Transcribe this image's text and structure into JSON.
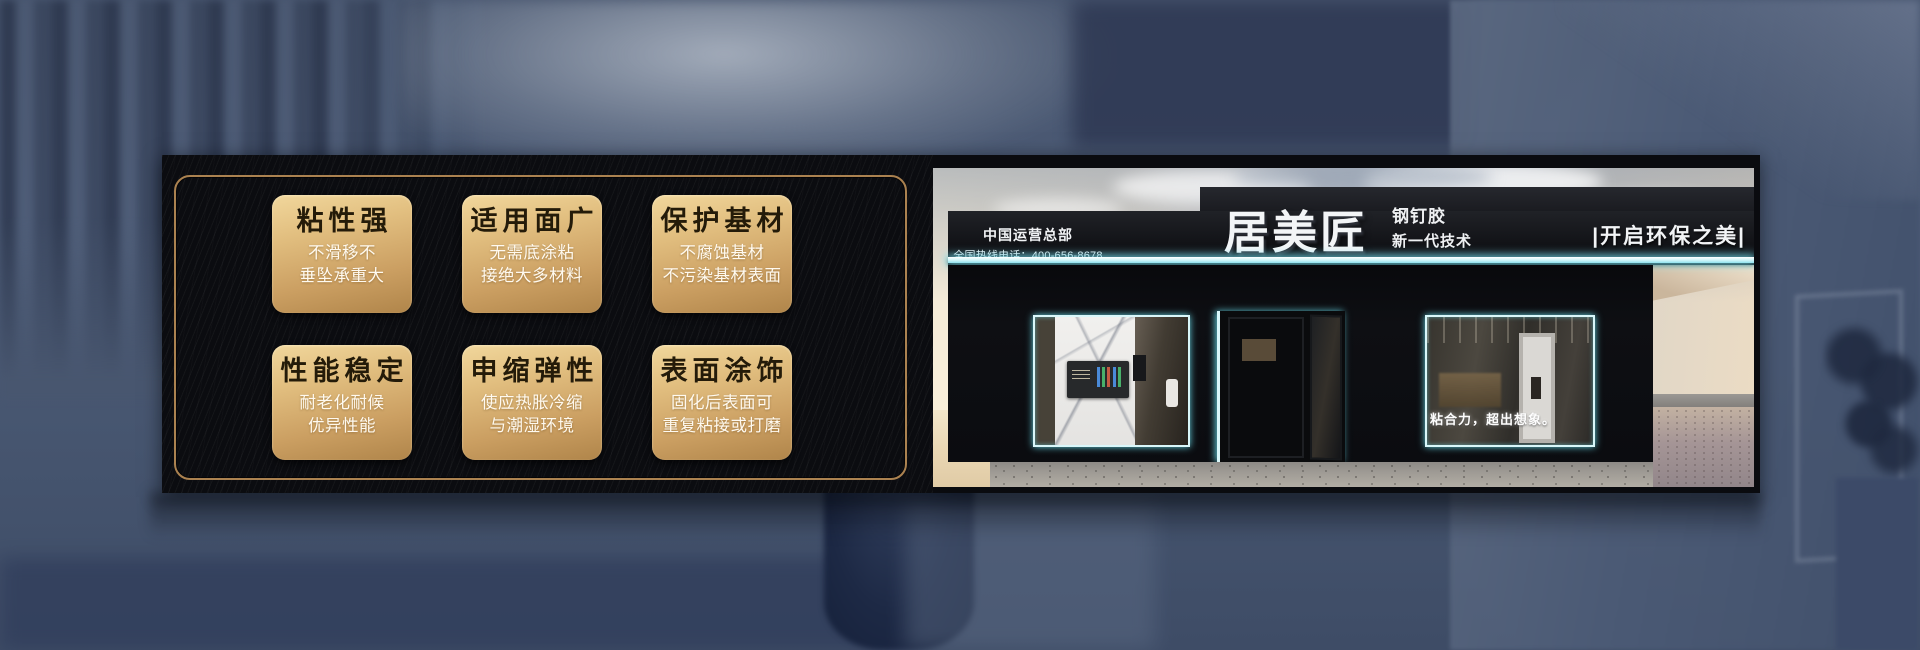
{
  "features": {
    "cards": [
      {
        "title": "粘性强",
        "line1": "不滑移不",
        "line2": "垂坠承重大"
      },
      {
        "title": "适用面广",
        "line1": "无需底涂粘",
        "line2": "接绝大多材料"
      },
      {
        "title": "保护基材",
        "line1": "不腐蚀基材",
        "line2": "不污染基材表面"
      },
      {
        "title": "性能稳定",
        "line1": "耐老化耐候",
        "line2": "优异性能"
      },
      {
        "title": "申缩弹性",
        "line1": "使应热胀冷缩",
        "line2": "与潮湿环境"
      },
      {
        "title": "表面涂饰",
        "line1": "固化后表面可",
        "line2": "重复粘接或打磨"
      }
    ]
  },
  "storefront": {
    "hq_label": "中国运营总部",
    "hotline": "全国热线电话：400-656-8678",
    "brand": "居美匠",
    "product": "钢钉胶",
    "tech": "新一代技术",
    "slogan_right": "|开启环保之美|",
    "window_slogan": "粘合力，超出想象。"
  },
  "colors": {
    "background_blue": "#4d5c77",
    "panel_black": "#0b0c10",
    "gold_border": "#ab8250",
    "card_gold_light": "#f1d79c",
    "card_gold_dark": "#b0854a",
    "card_title_text": "#241b09",
    "card_sub_text": "#fffaf0",
    "led_cyan": "#8fe3ee",
    "sign_black": "#17181d",
    "sign_text": "#f3f5f7"
  }
}
